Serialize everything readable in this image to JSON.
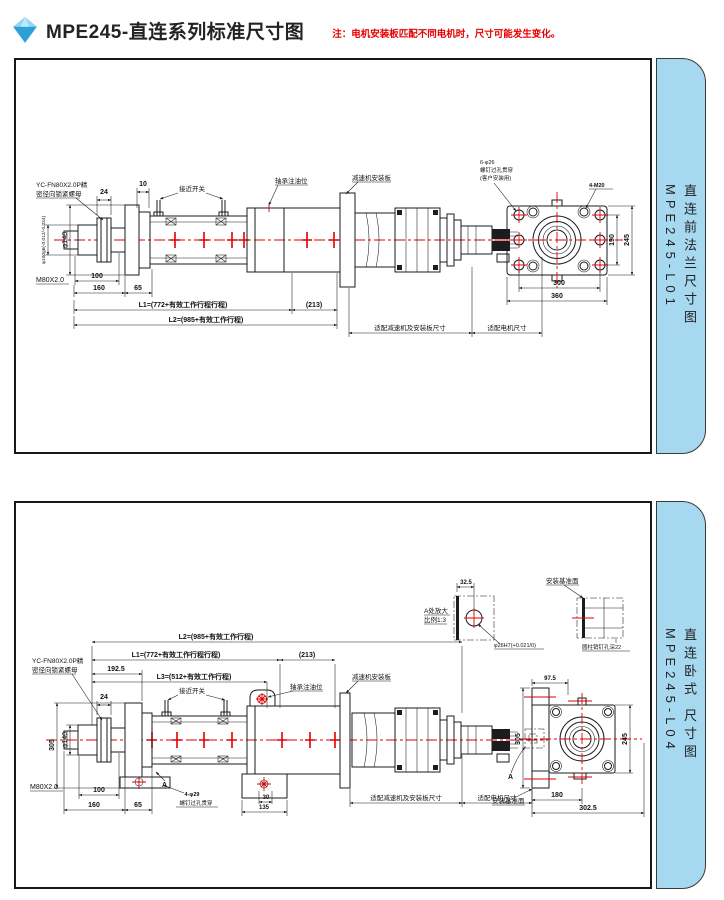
{
  "header": {
    "title": "MPE245-直连系列标准尺寸图",
    "note": "注：电机安装板匹配不同电机时，尺寸可能发生变化。"
  },
  "colors": {
    "tab_blue": "#a6d8f0",
    "centerline_red": "#e00000",
    "note_red": "#e60000",
    "line_dark": "#1b1b20"
  },
  "panel1": {
    "tab_title": "直连前法兰尺寸图",
    "tab_code": "MPE245-L01",
    "labels": {
      "lock_nut_1": "YC-FN80X2.0P精",
      "lock_nut_2": "密径向锁紧螺母",
      "dim_10": "10",
      "dim_24": "24",
      "proximity_switch": "接近开关",
      "oil_port": "轴承注油位",
      "reducer_plate": "减速机安装板",
      "dia_rod": "φ100g6(-0.012/-0.034)",
      "dia_flange": "φ140",
      "thread": "M80X2.0",
      "dim_100": "100",
      "dim_160": "160",
      "dim_65": "65",
      "dim_L1": "L1=(772+有效工作行程行程)",
      "dim_213": "(213)",
      "dim_L2": "L2=(985+有效工作行程)",
      "fit_reducer": "适配减速机及安装板尺寸",
      "fit_motor": "适配电机尺寸",
      "holes_through_1": "6-φ26",
      "holes_through_2": "螺钉过孔贯穿",
      "holes_through_3": "(客户安装用)",
      "holes_tapped": "4-M20",
      "dim_190": "190",
      "dim_245": "245",
      "dim_300": "300",
      "dim_360": "360"
    }
  },
  "panel2": {
    "tab_title": "直连卧式 尺寸图",
    "tab_code": "MPE245-L04",
    "labels": {
      "dim_L2": "L2=(985+有效工作行程)",
      "dim_L1": "L1=(772+有效工作行程行程)",
      "dim_213": "(213)",
      "dim_L3": "L3=(512+有效工作行程)",
      "dim_1925": "192.5",
      "lock_nut_1": "YC-FN80X2.0P精",
      "lock_nut_2": "密径向锁紧螺母",
      "proximity_switch": "接近开关",
      "oil_port": "轴承注油位",
      "reducer_plate": "减速机安装板",
      "dim_24": "24",
      "dim_305": "305",
      "dia_flange": "φ140",
      "thread": "M80X2.0",
      "dim_100": "100",
      "dim_160": "160",
      "dim_65": "65",
      "mark_a": "A",
      "holes_feet_1": "4-φ29",
      "holes_feet_2": "螺钉过孔贯穿",
      "dim_30": "30",
      "dim_135": "135",
      "fit_reducer": "适配减速机及安装板尺寸",
      "fit_motor": "适配电机尺寸",
      "detail_dim_325": "32.5",
      "detail_title_1": "A处放大",
      "detail_title_2": "比例1:3",
      "detail_hole": "φ26H7(+0.021/0)",
      "datum_top": "安装基准面",
      "pin_hole_note": "圆柱销钉孔深22",
      "dim_975": "97.5",
      "end_dim_305": "305",
      "end_dim_245": "245",
      "dim_180": "180",
      "dim_3025": "302.5",
      "datum_bottom": "安装基准面",
      "mark_a2": "A"
    }
  }
}
